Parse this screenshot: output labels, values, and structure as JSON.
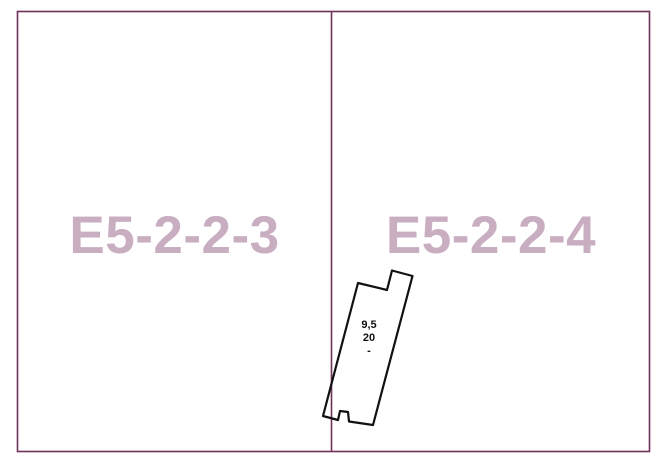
{
  "colors": {
    "background": "#ffffff",
    "boundary": "#703059",
    "zone_label": "#c9aec1",
    "plot_outline": "#111111",
    "plot_text": "#111111"
  },
  "zones": [
    {
      "label": "E5-2-2-3"
    },
    {
      "label": "E5-2-2-4"
    }
  ],
  "plot": {
    "dimension_line1": "9,5",
    "dimension_line2": "20",
    "dimension_line3": "-"
  }
}
